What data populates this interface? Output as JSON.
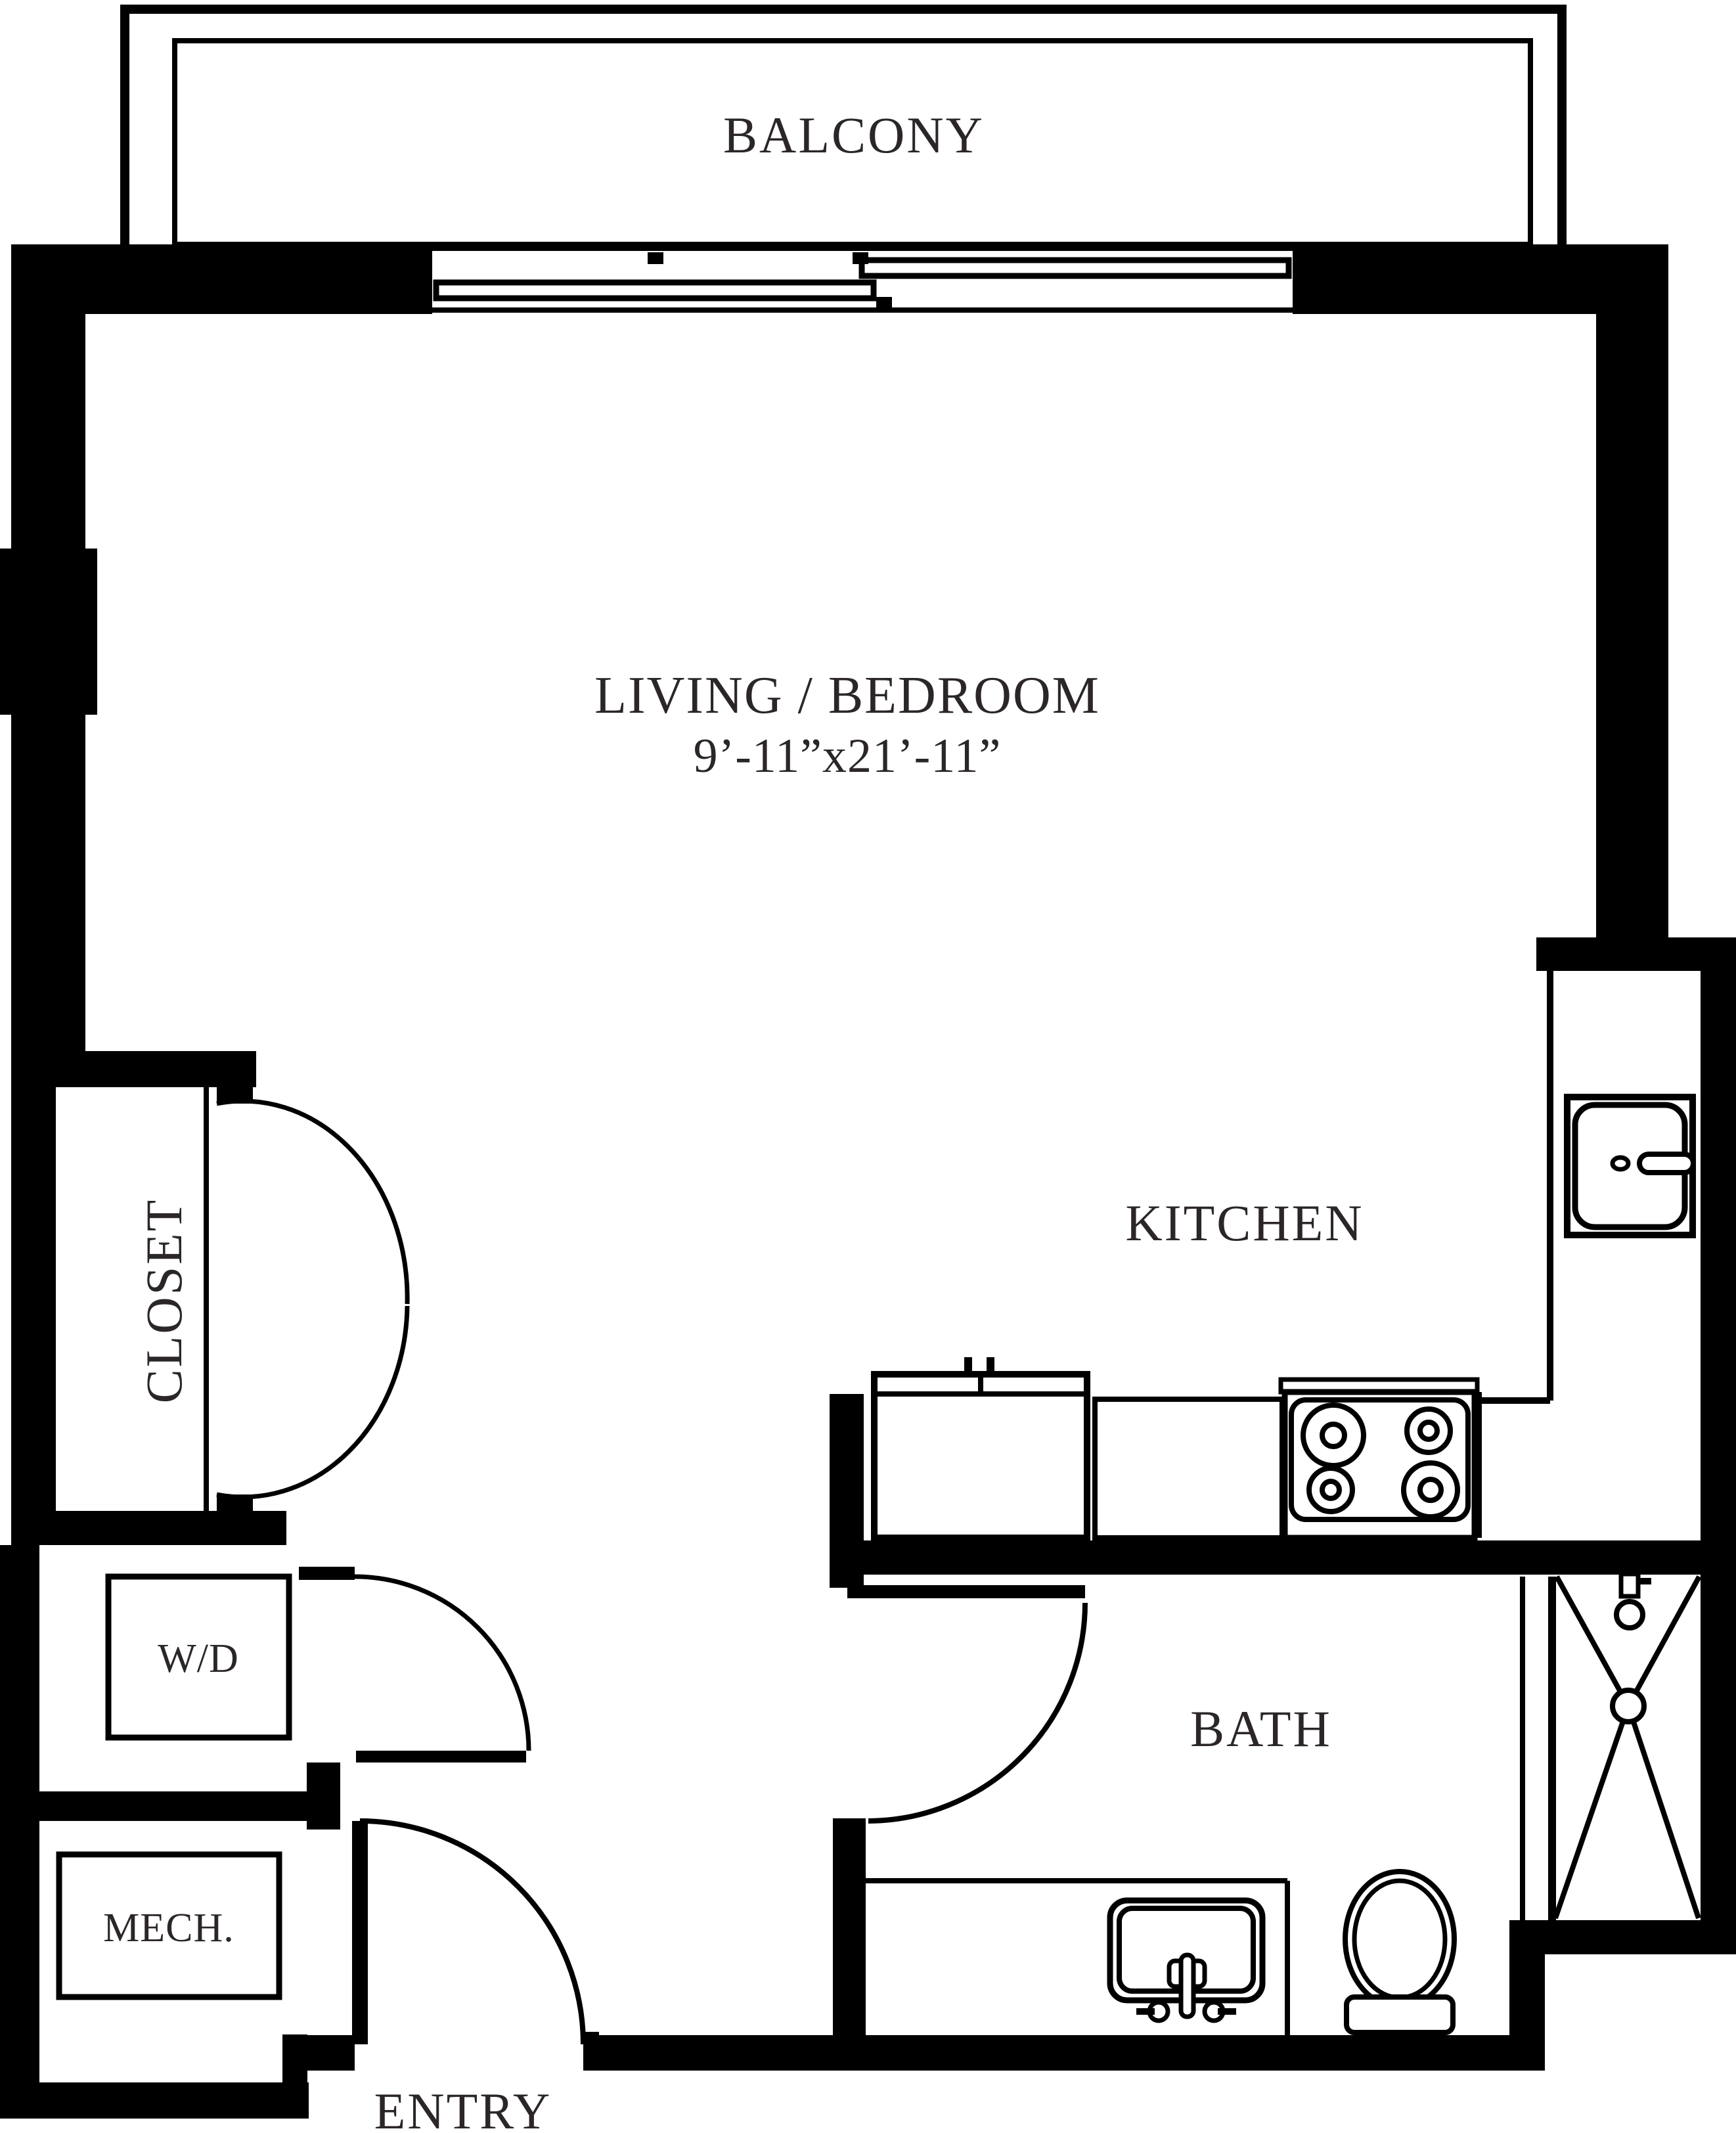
{
  "title": "Studio apartment floor plan",
  "colors": {
    "background": "#ffffff",
    "line": "#000000",
    "text": "#2b2627"
  },
  "rooms": {
    "balcony": {
      "label": "BALCONY"
    },
    "living_bedroom": {
      "label": "LIVING / BEDROOM",
      "dimensions": "9’-11”x21’-11”"
    },
    "kitchen": {
      "label": "KITCHEN"
    },
    "closet": {
      "label": "CLOSET"
    },
    "laundry": {
      "label": "W/D"
    },
    "mechanical": {
      "label": "MECH."
    },
    "bath": {
      "label": "BATH"
    },
    "entry": {
      "label": "ENTRY"
    }
  },
  "fixtures": [
    "sliding-window",
    "kitchen-sink",
    "kitchen-counter",
    "stove-cooktop",
    "bath-vanity-sink",
    "toilet",
    "shower",
    "shower-head",
    "shower-drain",
    "washer-dryer-box",
    "mechanical-box",
    "entry-door",
    "bath-door",
    "closet-double-doors",
    "laundry-door"
  ]
}
